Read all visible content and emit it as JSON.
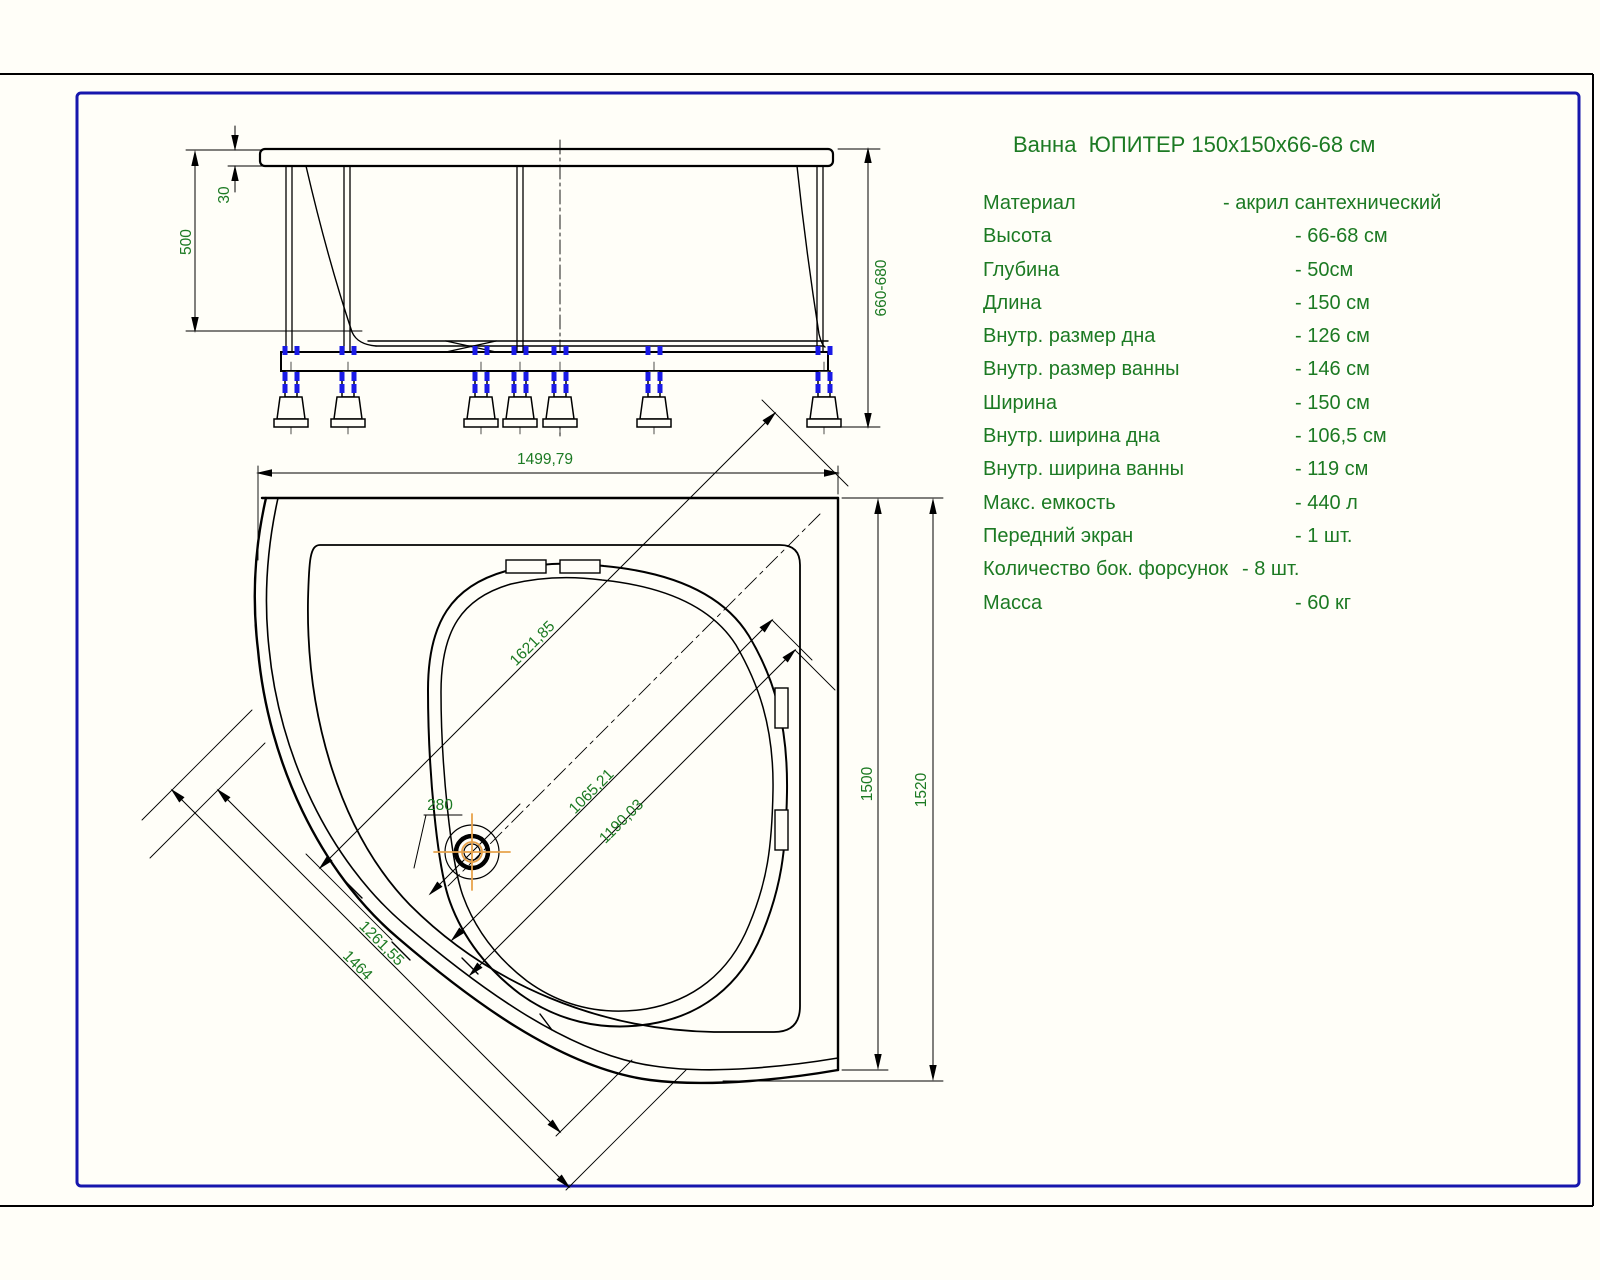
{
  "title": "Ванна  ЮПИТЕР 150x150x66-68 см",
  "specs": [
    {
      "label": "Материал",
      "value": "- акрил сантехнический"
    },
    {
      "label": "Высота",
      "value": "- 66-68 см"
    },
    {
      "label": "Глубина",
      "value": "- 50см"
    },
    {
      "label": "Длина",
      "value": "- 150 см"
    },
    {
      "label": "Внутр. размер дна",
      "value": "- 126 см"
    },
    {
      "label": "Внутр. размер ванны",
      "value": "- 146 см"
    },
    {
      "label": "Ширина",
      "value": "- 150 см"
    },
    {
      "label": "Внутр. ширина дна",
      "value": "- 106,5 см"
    },
    {
      "label": "Внутр. ширина ванны",
      "value": "- 119 см"
    },
    {
      "label": "Макс. емкость",
      "value": "- 440 л"
    },
    {
      "label": "Передний экран",
      "value": "- 1 шт."
    },
    {
      "label": "Количество бок. форсунок",
      "value": "- 8 шт."
    },
    {
      "label": "Масса",
      "value": "- 60 кг"
    }
  ],
  "front_view": {
    "depth": "500",
    "rim_thickness": "30",
    "height": "660-680"
  },
  "plan_view": {
    "width": "1499,79",
    "side": "1500",
    "overall": "1520",
    "diagonal": "1621,85",
    "inner_bottom_diag": "1065,21",
    "inner_diag": "1190,03",
    "front_chord_inner": "1261,55",
    "front_chord_outer": "1464",
    "drain_offset": "280"
  },
  "colors": {
    "line": "#000000",
    "dimension_text": "#1c7a23",
    "bolt_blue": "#1a1ae6",
    "drain_orange": "#e8a24a",
    "border_blue": "#1717ad"
  }
}
